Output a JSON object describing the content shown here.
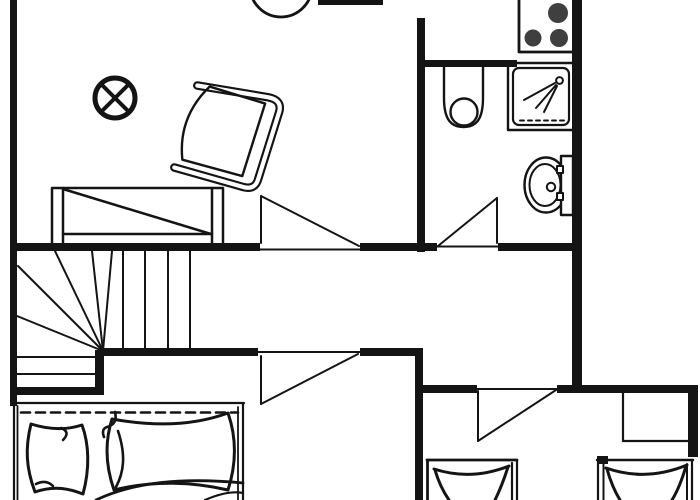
{
  "canvas": {
    "width": 700,
    "height": 500,
    "bg": "#ffffff",
    "ink": "#141414",
    "burner_color": "#3f3f3f"
  },
  "shapes": [
    {
      "name": "round-table",
      "type": "circle",
      "cx": 281,
      "cy": -14,
      "r": 31,
      "sw": 2.8
    },
    {
      "name": "ceiling-light-icon",
      "type": "circle",
      "cx": 115,
      "cy": 98,
      "r": 20,
      "sw": 5
    },
    {
      "name": "ceiling-light-cross-a",
      "type": "line",
      "x1": 101,
      "y1": 84,
      "x2": 129,
      "y2": 112,
      "sw": 4
    },
    {
      "name": "ceiling-light-cross-b",
      "type": "line",
      "x1": 129,
      "y1": 84,
      "x2": 101,
      "y2": 112,
      "sw": 4
    },
    {
      "name": "armchair",
      "type": "g",
      "transform": "translate(225,131) rotate(19)",
      "children": [
        {
          "name": "armchair-frame-outer",
          "type": "path",
          "d": "M -41,-34 L 30,-46 Q 44,-48 45,-36 L 47,34 Q 48,46 36,47 L -36,51",
          "sw": 8.5
        },
        {
          "name": "armchair-frame-inner",
          "type": "path",
          "d": "M -41,-34 L 30,-46 Q 44,-48 45,-36 L 47,34 Q 48,46 36,47 L -36,51",
          "sw": 4.2,
          "stroke": "white"
        },
        {
          "name": "armchair-seat",
          "type": "path",
          "d": "M 29,-39 L 31,37 L -31,41 Q -49,2 -29,-37 Z",
          "sw": 2.4
        }
      ]
    },
    {
      "name": "sofa-outline",
      "type": "rect",
      "x": 52,
      "y": 188,
      "w": 171,
      "h": 58,
      "sw": 2.5
    },
    {
      "name": "sofa-armrest-left",
      "type": "line",
      "x1": 63,
      "y1": 188,
      "x2": 63,
      "y2": 246,
      "sw": 2.5
    },
    {
      "name": "sofa-armrest-right",
      "type": "line",
      "x1": 212,
      "y1": 188,
      "x2": 212,
      "y2": 246,
      "sw": 2.5
    },
    {
      "name": "sofa-front-edge",
      "type": "line",
      "x1": 63,
      "y1": 234,
      "x2": 212,
      "y2": 234,
      "sw": 2.5
    },
    {
      "name": "sofa-diagonal",
      "type": "line",
      "x1": 63,
      "y1": 189,
      "x2": 211,
      "y2": 234,
      "sw": 2.5
    },
    {
      "name": "stove",
      "type": "rect",
      "x": 519,
      "y": -6,
      "w": 57,
      "h": 58,
      "sw": 2.8,
      "fill": "#ffffff"
    },
    {
      "name": "stove-burner-1",
      "type": "circle",
      "cx": 558,
      "cy": 13,
      "r": 10,
      "fill": "burner"
    },
    {
      "name": "stove-burner-2",
      "type": "circle",
      "cx": 533,
      "cy": 38,
      "r": 8.5,
      "fill": "burner"
    },
    {
      "name": "stove-burner-3",
      "type": "circle",
      "cx": 559,
      "cy": 38,
      "r": 9,
      "fill": "burner"
    },
    {
      "name": "toilet-outline",
      "type": "path",
      "d": "M 444,64 L 444,98 C 444,121 452,127 463.5,127 C 475,127 483,121 483,98 L 483,64",
      "sw": 2.4
    },
    {
      "name": "toilet-bowl",
      "type": "circle",
      "cx": 464,
      "cy": 112,
      "r": 13.5,
      "sw": 2.4
    },
    {
      "name": "shower-tray-outer",
      "type": "rect",
      "x": 508,
      "y": 63,
      "w": 66,
      "h": 67,
      "sw": 2.4
    },
    {
      "name": "shower-tray-inner",
      "type": "rect",
      "x": 513,
      "y": 68,
      "w": 56,
      "h": 57,
      "rx": 6,
      "sw": 2.2
    },
    {
      "name": "shower-drain-dashes",
      "type": "line",
      "x1": 520,
      "y1": 120.5,
      "x2": 566,
      "y2": 120.5,
      "sw": 2,
      "dash": "4,4"
    },
    {
      "name": "shower-head-icon",
      "type": "circle",
      "cx": 559.5,
      "cy": 80.5,
      "r": 3.4,
      "sw": 2
    },
    {
      "name": "shower-spray-1",
      "type": "line",
      "x1": 555,
      "y1": 83,
      "x2": 524,
      "y2": 100,
      "sw": 2
    },
    {
      "name": "shower-spray-2",
      "type": "line",
      "x1": 556,
      "y1": 85,
      "x2": 536,
      "y2": 108,
      "sw": 2
    },
    {
      "name": "shower-spray-3",
      "type": "line",
      "x1": 557,
      "y1": 86,
      "x2": 544,
      "y2": 112,
      "sw": 2
    },
    {
      "name": "bidet-rim-outer",
      "type": "ellipse",
      "cx": 546,
      "cy": 185,
      "rx": 21.5,
      "ry": 27.5,
      "sw": 2.4
    },
    {
      "name": "bidet-rim-inner",
      "type": "ellipse",
      "cx": 545,
      "cy": 185,
      "rx": 15.5,
      "ry": 21,
      "sw": 2
    },
    {
      "name": "bidet-drain",
      "type": "circle",
      "cx": 551,
      "cy": 187,
      "r": 4.2,
      "sw": 2
    },
    {
      "name": "bidet-tank",
      "type": "rect",
      "x": 561,
      "y": 156,
      "w": 12,
      "h": 59,
      "sw": 2.4,
      "fill": "#ffffff"
    },
    {
      "name": "bidet-hinge-top",
      "type": "rect",
      "x": 557,
      "y": 166,
      "w": 6,
      "h": 7,
      "sw": 2,
      "fill": "#ffffff"
    },
    {
      "name": "bidet-hinge-bottom",
      "type": "rect",
      "x": 557,
      "y": 193,
      "w": 6,
      "h": 7,
      "sw": 2,
      "fill": "#ffffff"
    },
    {
      "name": "stair-tread-v1",
      "type": "line",
      "x1": 123,
      "y1": 251,
      "x2": 123,
      "y2": 349,
      "sw": 2
    },
    {
      "name": "stair-tread-v2",
      "type": "line",
      "x1": 145,
      "y1": 251,
      "x2": 145,
      "y2": 349,
      "sw": 2
    },
    {
      "name": "stair-tread-v3",
      "type": "line",
      "x1": 168,
      "y1": 251,
      "x2": 168,
      "y2": 349,
      "sw": 2
    },
    {
      "name": "stair-tread-v4",
      "type": "line",
      "x1": 190,
      "y1": 251,
      "x2": 190,
      "y2": 349,
      "sw": 2
    },
    {
      "name": "stair-winder-1",
      "type": "line",
      "x1": 103,
      "y1": 351,
      "x2": 18,
      "y2": 266,
      "sw": 2
    },
    {
      "name": "stair-winder-2",
      "type": "line",
      "x1": 103,
      "y1": 351,
      "x2": 55,
      "y2": 251,
      "sw": 2
    },
    {
      "name": "stair-winder-3",
      "type": "line",
      "x1": 103,
      "y1": 351,
      "x2": 92,
      "y2": 251,
      "sw": 2
    },
    {
      "name": "stair-winder-4",
      "type": "line",
      "x1": 103,
      "y1": 351,
      "x2": 112,
      "y2": 251,
      "sw": 2
    },
    {
      "name": "stair-winder-5",
      "type": "line",
      "x1": 103,
      "y1": 351,
      "x2": 17,
      "y2": 316,
      "sw": 2
    },
    {
      "name": "stair-tread-h1",
      "type": "line",
      "x1": 17,
      "y1": 357,
      "x2": 100,
      "y2": 357,
      "sw": 2
    },
    {
      "name": "stair-tread-h2",
      "type": "line",
      "x1": 17,
      "y1": 374,
      "x2": 100,
      "y2": 374,
      "sw": 2
    },
    {
      "name": "double-bed-top-edge",
      "type": "line",
      "x1": 13,
      "y1": 403,
      "x2": 244,
      "y2": 403,
      "sw": 2.2
    },
    {
      "name": "double-bed-left-edge",
      "type": "line",
      "x1": 14,
      "y1": 403,
      "x2": 14,
      "y2": 500,
      "sw": 2.2
    },
    {
      "name": "double-bed-left-inner",
      "type": "line",
      "x1": 17.5,
      "y1": 406,
      "x2": 17.5,
      "y2": 500,
      "sw": 1.8
    },
    {
      "name": "double-bed-right-edge",
      "type": "line",
      "x1": 243,
      "y1": 403,
      "x2": 243,
      "y2": 500,
      "sw": 2.2
    },
    {
      "name": "double-bed-right-inner",
      "type": "line",
      "x1": 238,
      "y1": 407,
      "x2": 238,
      "y2": 500,
      "sw": 1.8
    },
    {
      "name": "double-bed-sheet-dashed",
      "type": "line",
      "x1": 21,
      "y1": 412.5,
      "x2": 238,
      "y2": 412.5,
      "sw": 2.6,
      "dash": "9,6"
    },
    {
      "name": "pillow-left",
      "type": "path",
      "d": "M 31,424 C 25,448 26,468 35,492 C 55,485 70,489 83,494 C 90,468 89,444 82,425 C 64,431 47,429 31,424 Z",
      "sw": 3,
      "fill": "#ffffff"
    },
    {
      "name": "pillow-left-fold-1",
      "type": "path",
      "d": "M 61,428 Q 71,432 63,440",
      "sw": 2.6
    },
    {
      "name": "pillow-left-fold-2",
      "type": "path",
      "d": "M 36,484 Q 46,479 53,486",
      "sw": 2.6
    },
    {
      "name": "pillow-right",
      "type": "path",
      "d": "M 112,419 C 104,444 106,467 114,490 C 154,480 194,482 228,490 C 237,462 236,436 228,413 C 190,427 150,426 112,419 Z",
      "sw": 3,
      "fill": "#ffffff"
    },
    {
      "name": "pillow-right-fold-1",
      "type": "path",
      "d": "M 118,431 C 126,455 124,472 116,487",
      "sw": 2.6
    },
    {
      "name": "pillow-right-fold-2",
      "type": "path",
      "d": "M 115,412 Q 118,424 107,427 Q 101,429 104,437",
      "sw": 2.6
    },
    {
      "name": "duvet-edge-1",
      "type": "path",
      "d": "M 96,500 Q 150,474 243,483",
      "sw": 2.8
    },
    {
      "name": "duvet-edge-2",
      "type": "path",
      "d": "M 205,500 Q 228,490 243,493",
      "sw": 2.2
    },
    {
      "name": "single-bed-1-top",
      "type": "line",
      "x1": 427,
      "y1": 460,
      "x2": 517,
      "y2": 460,
      "sw": 2.8
    },
    {
      "name": "single-bed-1-left",
      "type": "line",
      "x1": 427.5,
      "y1": 460,
      "x2": 427.5,
      "y2": 500,
      "sw": 2.8
    },
    {
      "name": "single-bed-1-right",
      "type": "line",
      "x1": 517,
      "y1": 460,
      "x2": 517,
      "y2": 500,
      "sw": 2.2
    },
    {
      "name": "single-bed-1-right-inner",
      "type": "line",
      "x1": 512,
      "y1": 463,
      "x2": 512,
      "y2": 500,
      "sw": 2.2
    },
    {
      "name": "single-bed-1-mattress-top",
      "type": "path",
      "d": "M 434,469 Q 471,481 509,466",
      "sw": 3
    },
    {
      "name": "single-bed-1-mattress-left",
      "type": "path",
      "d": "M 435,470 Q 440,487 449,500",
      "sw": 3
    },
    {
      "name": "single-bed-1-mattress-right",
      "type": "path",
      "d": "M 508,467 Q 502,486 495,500",
      "sw": 3
    },
    {
      "name": "single-bed-2-corner-stub",
      "type": "rect",
      "x": 597,
      "y": 456,
      "w": 11,
      "h": 8,
      "fill": "ink"
    },
    {
      "name": "single-bed-2-top",
      "type": "line",
      "x1": 597,
      "y1": 460,
      "x2": 693,
      "y2": 460,
      "sw": 2.4
    },
    {
      "name": "single-bed-2-left",
      "type": "line",
      "x1": 598,
      "y1": 460,
      "x2": 598,
      "y2": 500,
      "sw": 2.2
    },
    {
      "name": "single-bed-2-left-inner",
      "type": "line",
      "x1": 603.5,
      "y1": 464,
      "x2": 603.5,
      "y2": 500,
      "sw": 2
    },
    {
      "name": "single-bed-2-right",
      "type": "line",
      "x1": 692,
      "y1": 460,
      "x2": 692,
      "y2": 500,
      "sw": 2.2
    },
    {
      "name": "single-bed-2-right-inner",
      "type": "line",
      "x1": 687,
      "y1": 464,
      "x2": 687,
      "y2": 500,
      "sw": 2
    },
    {
      "name": "single-bed-2-mattress-top",
      "type": "path",
      "d": "M 606,468 Q 646,482 687,465",
      "sw": 3
    },
    {
      "name": "single-bed-2-mattress-left",
      "type": "path",
      "d": "M 607,469 Q 612,487 620,500",
      "sw": 3
    },
    {
      "name": "single-bed-2-mattress-right",
      "type": "path",
      "d": "M 686,466 Q 680,487 672,500",
      "sw": 3
    },
    {
      "name": "wardrobe-left-edge",
      "type": "line",
      "x1": 623,
      "y1": 393,
      "x2": 623,
      "y2": 441,
      "sw": 2.2
    },
    {
      "name": "wardrobe-bottom-edge",
      "type": "line",
      "x1": 623,
      "y1": 441,
      "x2": 688,
      "y2": 441,
      "sw": 2.2
    },
    {
      "name": "door-threshold-living",
      "type": "line",
      "x1": 260,
      "y1": 249.5,
      "x2": 360,
      "y2": 249.5,
      "sw": 2
    },
    {
      "name": "door-leaf-living",
      "type": "line",
      "x1": 261,
      "y1": 196,
      "x2": 261,
      "y2": 243,
      "sw": 2
    },
    {
      "name": "door-swing-living",
      "type": "line",
      "x1": 261,
      "y1": 196,
      "x2": 359,
      "y2": 246,
      "sw": 2
    },
    {
      "name": "door-threshold-bathroom",
      "type": "line",
      "x1": 437,
      "y1": 246.5,
      "x2": 498,
      "y2": 246.5,
      "sw": 2
    },
    {
      "name": "door-leaf-bathroom",
      "type": "line",
      "x1": 497,
      "y1": 198,
      "x2": 497,
      "y2": 243,
      "sw": 2
    },
    {
      "name": "door-swing-bathroom",
      "type": "line",
      "x1": 497,
      "y1": 198,
      "x2": 438,
      "y2": 246,
      "sw": 2
    },
    {
      "name": "door-threshold-hall",
      "type": "line",
      "x1": 258,
      "y1": 352,
      "x2": 360,
      "y2": 352,
      "sw": 2
    },
    {
      "name": "door-leaf-hall",
      "type": "line",
      "x1": 261,
      "y1": 356,
      "x2": 261,
      "y2": 404,
      "sw": 2
    },
    {
      "name": "door-swing-hall",
      "type": "line",
      "x1": 261,
      "y1": 404,
      "x2": 358,
      "y2": 354,
      "sw": 2
    },
    {
      "name": "door-threshold-bedroom",
      "type": "line",
      "x1": 477,
      "y1": 389,
      "x2": 557,
      "y2": 389,
      "sw": 2
    },
    {
      "name": "door-leaf-bedroom",
      "type": "line",
      "x1": 478,
      "y1": 391,
      "x2": 478,
      "y2": 441,
      "sw": 2
    },
    {
      "name": "door-swing-bedroom",
      "type": "line",
      "x1": 478,
      "y1": 441,
      "x2": 556,
      "y2": 390,
      "sw": 2
    },
    {
      "name": "wall-left",
      "type": "rect",
      "x": 10,
      "y": 0,
      "w": 7,
      "h": 406,
      "fill": "ink"
    },
    {
      "name": "wall-top-segment",
      "type": "rect",
      "x": 318,
      "y": 0,
      "w": 65,
      "h": 5,
      "fill": "ink"
    },
    {
      "name": "wall-kitchen-divider",
      "type": "rect",
      "x": 417,
      "y": 18,
      "w": 8,
      "h": 234,
      "fill": "ink"
    },
    {
      "name": "wall-bathroom-top",
      "type": "rect",
      "x": 417,
      "y": 60,
      "w": 100,
      "h": 7,
      "fill": "ink"
    },
    {
      "name": "wall-right-upper",
      "type": "rect",
      "x": 572,
      "y": 0,
      "w": 10,
      "h": 392,
      "fill": "ink"
    },
    {
      "name": "wall-hall-a",
      "type": "rect",
      "x": 10,
      "y": 243,
      "w": 250,
      "h": 8,
      "fill": "ink"
    },
    {
      "name": "wall-hall-b",
      "type": "rect",
      "x": 360,
      "y": 243,
      "w": 77,
      "h": 8,
      "fill": "ink"
    },
    {
      "name": "wall-hall-c",
      "type": "rect",
      "x": 498,
      "y": 243,
      "w": 84,
      "h": 8,
      "fill": "ink"
    },
    {
      "name": "wall-landing-a",
      "type": "rect",
      "x": 103,
      "y": 348,
      "w": 155,
      "h": 8,
      "fill": "ink"
    },
    {
      "name": "wall-landing-b",
      "type": "rect",
      "x": 360,
      "y": 348,
      "w": 63,
      "h": 8,
      "fill": "ink"
    },
    {
      "name": "wall-bedroom-divider",
      "type": "rect",
      "x": 415,
      "y": 350,
      "w": 8,
      "h": 150,
      "fill": "ink"
    },
    {
      "name": "wall-stair-vertical",
      "type": "rect",
      "x": 95,
      "y": 350,
      "w": 9,
      "h": 45,
      "fill": "ink"
    },
    {
      "name": "wall-stair-horizontal",
      "type": "rect",
      "x": 10,
      "y": 387,
      "w": 94,
      "h": 8,
      "fill": "ink"
    },
    {
      "name": "wall-lower-a",
      "type": "rect",
      "x": 415,
      "y": 385,
      "w": 62,
      "h": 8,
      "fill": "ink"
    },
    {
      "name": "wall-lower-b",
      "type": "rect",
      "x": 557,
      "y": 385,
      "w": 141,
      "h": 8,
      "fill": "ink"
    },
    {
      "name": "wall-right-lower",
      "type": "rect",
      "x": 688,
      "y": 385,
      "w": 10,
      "h": 72,
      "fill": "ink"
    }
  ]
}
